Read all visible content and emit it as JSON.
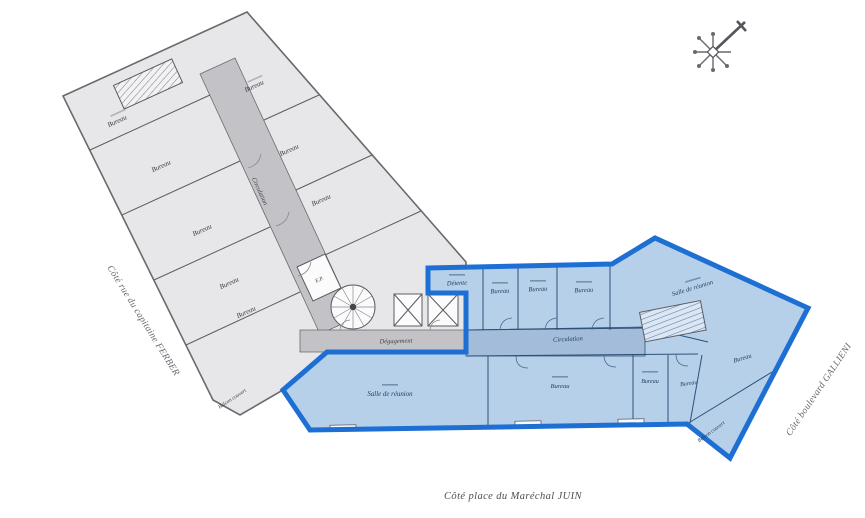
{
  "plan": {
    "street_left": "Côté rue du capitaine FERBER",
    "street_right": "Côté boulevard GALLIENI",
    "street_bottom": "Côté place du Maréchal JUIN"
  },
  "icons": {
    "compass": "compass-north-rose"
  },
  "colors": {
    "highlight_border": "#1e6fd4",
    "highlight_fill": "#b7d0ea",
    "highlight_corridor": "#a3bcd9",
    "existing_fill": "#e7e7e9",
    "existing_corridor": "#c3c3c7",
    "wall": "#5c5c62"
  },
  "gray_wing": {
    "corridor": "Circulation",
    "degagement": "Dégagement",
    "ep": "E.P.",
    "balcony": "Balcon couvert",
    "rooms": [
      "Bureau",
      "Bureau",
      "Bureau",
      "Bureau",
      "Bureau",
      "Bureau",
      "Bureau",
      "Bureau"
    ]
  },
  "blue_wing": {
    "corridor": "Circulation",
    "balcony": "Balcon couvert",
    "rooms": [
      "Détente",
      "Bureau",
      "Bureau",
      "Bureau",
      "Salle de réunion",
      "Bureau",
      "Salle de réunion",
      "Bureau",
      "Bureau",
      "Bureau"
    ]
  }
}
